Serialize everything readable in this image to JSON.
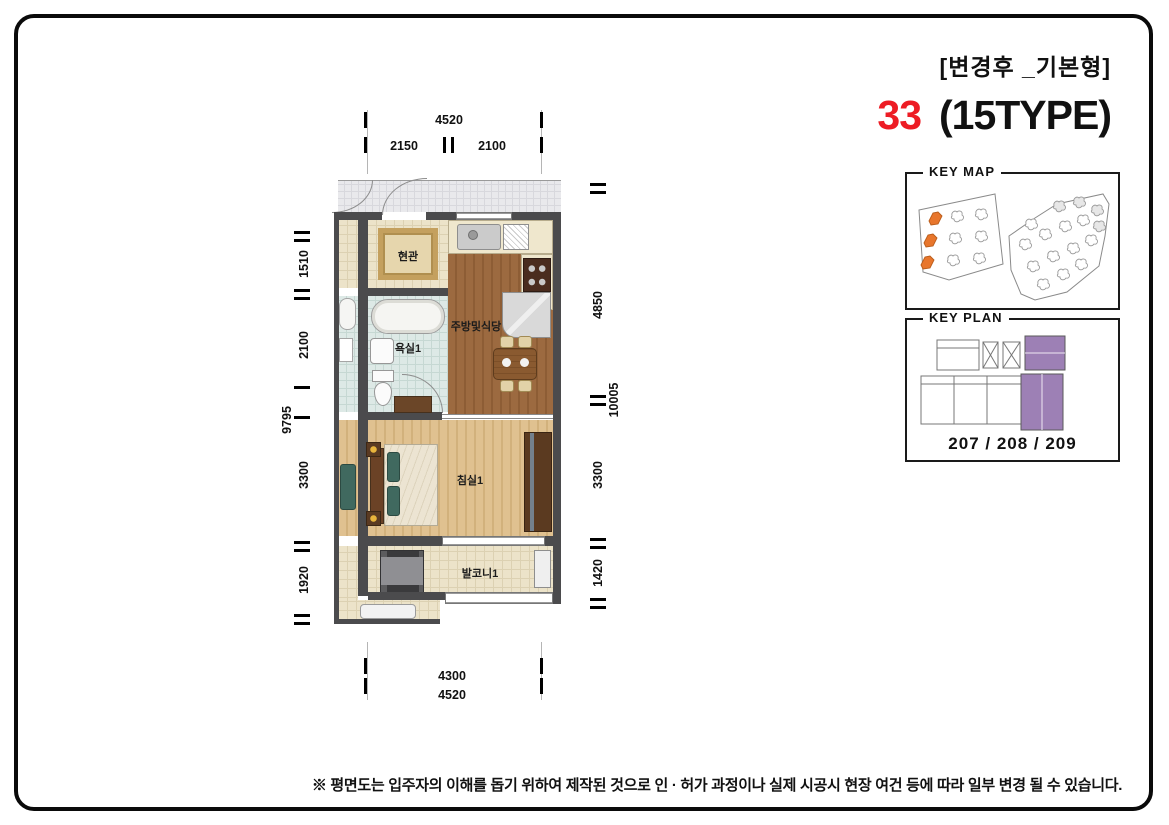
{
  "header": {
    "revision_label": "[변경후 _기본형]",
    "unit_number": "33",
    "type_label": "(15TYPE)"
  },
  "key_map": {
    "title": "KEY MAP"
  },
  "key_plan": {
    "title": "KEY PLAN",
    "unit_numbers": "207 / 208 / 209"
  },
  "floor_plan": {
    "rooms": {
      "entrance": "현관",
      "bathroom1": "욕실1",
      "kitchen_dining": "주방및식당",
      "bedroom1": "침실1",
      "balcony1": "발코니1"
    },
    "dimensions": {
      "top": {
        "overall": "4520",
        "seg1": "2150",
        "seg2": "2100"
      },
      "bottom": {
        "seg1": "4300",
        "overall": "4520"
      },
      "left": {
        "seg1": "1510",
        "seg2": "2100",
        "seg3": "3300",
        "seg4": "1920",
        "overall": "9795"
      },
      "right": {
        "seg1": "4850",
        "seg2": "3300",
        "seg3": "1420",
        "overall": "10005"
      }
    }
  },
  "footnote": "※ 평면도는 입주자의 이해를 돕기 위하여 제작된 것으로 인 · 허가 과정이나 실제 시공시 현장 여건 등에 따라 일부 변경 될 수 있습니다.",
  "colors": {
    "accent_red": "#ed1c24",
    "keymap_highlight_orange": "#e8762c",
    "keyplan_highlight_purple": "#9d80b5",
    "wall_gray": "#4b4b4d"
  }
}
